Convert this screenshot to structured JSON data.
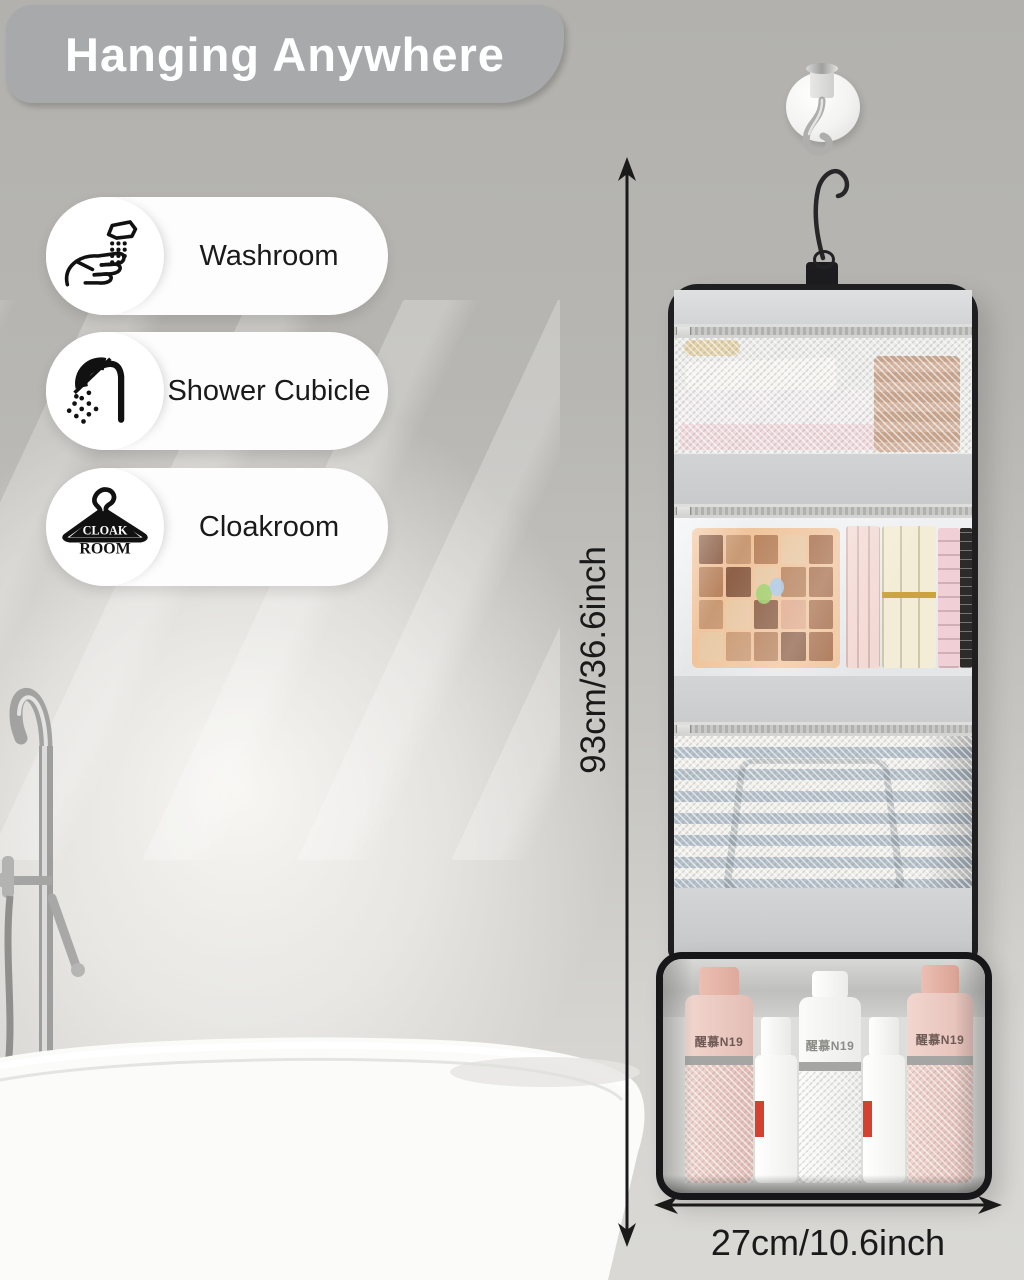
{
  "banner": {
    "title": "Hanging Anywhere"
  },
  "features": [
    {
      "label": "Washroom",
      "icon": "washroom-hands-faucet-icon"
    },
    {
      "label": "Shower Cubicle",
      "icon": "shower-head-icon"
    },
    {
      "label": "Cloakroom",
      "icon": "coat-hanger-icon",
      "icon_text_line1": "CLOAK",
      "icon_text_line2": "ROOM"
    }
  ],
  "dimensions": {
    "height_label": "93cm/36.6inch",
    "width_label": "27cm/10.6inch"
  },
  "product": {
    "bottle_labels": {
      "left_pink": "醒慕N19",
      "center_white": "醒慕N19",
      "right_pink": "醒慕N19"
    }
  },
  "colors": {
    "banner_gray": "#a7a9ab",
    "background_gray": "#b5b4b0",
    "badge_white": "#fdfdfd",
    "text_dark": "#1a1a1a",
    "bag_trim_black": "#1f1f22",
    "bag_fabric_gray": "#d6d7d9",
    "towel_stripe_blue": "#b4c0ca",
    "bottle_pink": "#edccc5",
    "spray_accent_red": "#d6402f"
  }
}
